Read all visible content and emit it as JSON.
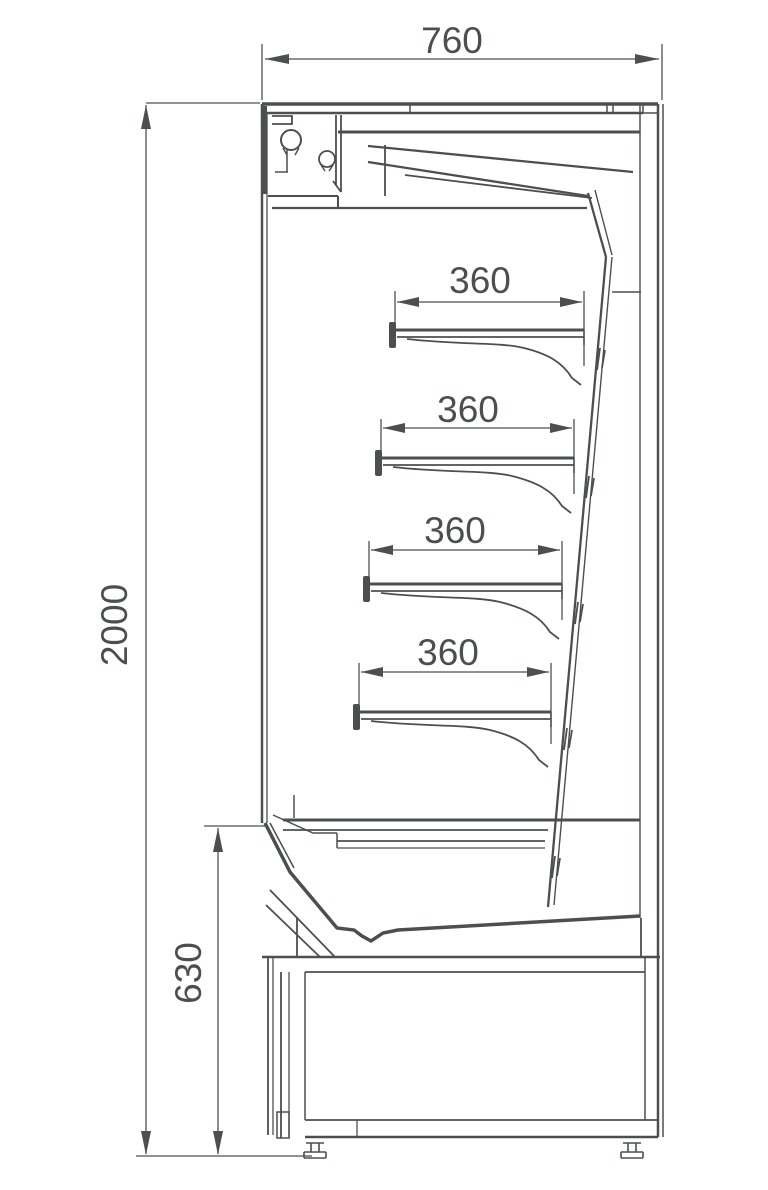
{
  "page": {
    "background": "#ffffff"
  },
  "dimensions_mm": {
    "overall_width": 760,
    "overall_height": 2000,
    "base_height": 630,
    "shelf_depths": [
      360,
      360,
      360,
      360
    ]
  },
  "drawing": {
    "viewbox": [
      0,
      0,
      768,
      1190
    ],
    "stroke": "#4b504d",
    "labels": [
      {
        "name": "dim-label-width-760",
        "text": "760",
        "x": 452,
        "y": 53,
        "rotate": 0,
        "size": 37
      },
      {
        "name": "dim-label-height-2000",
        "text": "2000",
        "x": 127,
        "y": 625,
        "rotate": -90,
        "size": 37
      },
      {
        "name": "dim-label-base-630",
        "text": "630",
        "x": 201,
        "y": 973,
        "rotate": -90,
        "size": 37
      },
      {
        "name": "dim-label-shelf1-360",
        "text": "360",
        "x": 480,
        "y": 293,
        "rotate": 0,
        "size": 37
      },
      {
        "name": "dim-label-shelf2-360",
        "text": "360",
        "x": 468,
        "y": 422,
        "rotate": 0,
        "size": 37
      },
      {
        "name": "dim-label-shelf3-360",
        "text": "360",
        "x": 455,
        "y": 543,
        "rotate": 0,
        "size": 37
      },
      {
        "name": "dim-label-shelf4-360",
        "text": "360",
        "x": 448,
        "y": 665,
        "rotate": 0,
        "size": 37
      }
    ],
    "arrows": [
      {
        "name": "arrow-760-left",
        "tip": [
          265,
          59
        ],
        "dir": "left",
        "len": 24,
        "hw": 5
      },
      {
        "name": "arrow-760-right",
        "tip": [
          659,
          59
        ],
        "dir": "right",
        "len": 24,
        "hw": 5
      },
      {
        "name": "arrow-2000-up",
        "tip": [
          146,
          105
        ],
        "dir": "up",
        "len": 24,
        "hw": 5
      },
      {
        "name": "arrow-2000-down",
        "tip": [
          146,
          1155
        ],
        "dir": "down",
        "len": 24,
        "hw": 5
      },
      {
        "name": "arrow-630-up",
        "tip": [
          218,
          828
        ],
        "dir": "up",
        "len": 24,
        "hw": 5
      },
      {
        "name": "arrow-630-down",
        "tip": [
          218,
          1155
        ],
        "dir": "down",
        "len": 24,
        "hw": 5
      },
      {
        "name": "arrow-s1-left",
        "tip": [
          397,
          302
        ],
        "dir": "left",
        "len": 22,
        "hw": 5
      },
      {
        "name": "arrow-s1-right",
        "tip": [
          582,
          302
        ],
        "dir": "right",
        "len": 22,
        "hw": 5
      },
      {
        "name": "arrow-s2-left",
        "tip": [
          383,
          428
        ],
        "dir": "left",
        "len": 22,
        "hw": 5
      },
      {
        "name": "arrow-s2-right",
        "tip": [
          572,
          428
        ],
        "dir": "right",
        "len": 22,
        "hw": 5
      },
      {
        "name": "arrow-s3-left",
        "tip": [
          371,
          550
        ],
        "dir": "left",
        "len": 22,
        "hw": 5
      },
      {
        "name": "arrow-s3-right",
        "tip": [
          560,
          550
        ],
        "dir": "right",
        "len": 22,
        "hw": 5
      },
      {
        "name": "arrow-s4-left",
        "tip": [
          361,
          672
        ],
        "dir": "left",
        "len": 22,
        "hw": 5
      },
      {
        "name": "arrow-s4-right",
        "tip": [
          549,
          672
        ],
        "dir": "right",
        "len": 22,
        "hw": 5
      }
    ],
    "circles": [
      {
        "name": "canopy-roller-large",
        "cx": 291,
        "cy": 140,
        "r": 10,
        "w": 2
      },
      {
        "name": "canopy-roller-small",
        "cx": 327,
        "cy": 159,
        "r": 8,
        "w": 1.8
      }
    ],
    "rects": [
      {
        "name": "shelf-1-front-lip",
        "x": 389,
        "y": 322,
        "w": 7,
        "h": 26
      },
      {
        "name": "shelf-2-front-lip",
        "x": 375,
        "y": 450,
        "w": 7,
        "h": 26
      },
      {
        "name": "shelf-3-front-lip",
        "x": 363,
        "y": 576,
        "w": 7,
        "h": 26
      },
      {
        "name": "shelf-4-front-lip",
        "x": 353,
        "y": 704,
        "w": 7,
        "h": 26
      }
    ],
    "paths": [
      {
        "name": "ext-760-left",
        "d": "M262,44 V100",
        "w": 1.3
      },
      {
        "name": "ext-760-right",
        "d": "M662,44 V100",
        "w": 1.3
      },
      {
        "name": "dimline-760",
        "d": "M265,59 H659",
        "w": 1.3
      },
      {
        "name": "ext-2000-top",
        "d": "M146,103 H260",
        "w": 1.3
      },
      {
        "name": "dimline-2000",
        "d": "M146,105 V1154",
        "w": 1.3
      },
      {
        "name": "ext-floor",
        "d": "M136,1156 H312",
        "w": 1.3
      },
      {
        "name": "ext-630-top",
        "d": "M204,826 H266",
        "w": 1.3
      },
      {
        "name": "dimline-630",
        "d": "M218,828 V1154",
        "w": 1.3
      },
      {
        "name": "ext-s1-left",
        "d": "M395,291 V327",
        "w": 1.3
      },
      {
        "name": "ext-s1-right",
        "d": "M584,291 V366",
        "w": 1.3
      },
      {
        "name": "dimline-s1",
        "d": "M397,302 H582",
        "w": 1.3
      },
      {
        "name": "ext-s2-left",
        "d": "M381,419 V455",
        "w": 1.3
      },
      {
        "name": "ext-s2-right",
        "d": "M574,419 V494",
        "w": 1.3
      },
      {
        "name": "dimline-s2",
        "d": "M383,428 H572",
        "w": 1.3
      },
      {
        "name": "ext-s3-left",
        "d": "M369,541 V579",
        "w": 1.3
      },
      {
        "name": "ext-s3-right",
        "d": "M562,541 V620",
        "w": 1.3
      },
      {
        "name": "dimline-s3",
        "d": "M371,550 H560",
        "w": 1.3
      },
      {
        "name": "ext-s4-left",
        "d": "M359,663 V705",
        "w": 1.3
      },
      {
        "name": "ext-s4-right",
        "d": "M551,663 V744",
        "w": 1.3
      },
      {
        "name": "dimline-s4",
        "d": "M361,672 H549",
        "w": 1.3
      },
      {
        "name": "top-cover-outer",
        "d": "M262,104 H658",
        "w": 3.5
      },
      {
        "name": "top-cover-inner",
        "d": "M262,113 H643",
        "w": 2.5
      },
      {
        "name": "top-cover-joints",
        "d": "M410,104 V113 M607,104 V113 M613,104 V113 M640,104 V113",
        "w": 1.5
      },
      {
        "name": "top-cover-end-cap",
        "d": "M643,104 V113 M658,104 V113 M643,113 H658",
        "w": 1.5
      },
      {
        "name": "top-right-drop",
        "d": "M640,113 V135",
        "w": 1.5
      },
      {
        "name": "right-wall-inner",
        "d": "M658,104 V1137",
        "w": 2.5
      },
      {
        "name": "right-wall-outer",
        "d": "M663,104 V1137",
        "w": 1.5
      },
      {
        "name": "front-edge-outer",
        "d": "M262,104 V823",
        "w": 2.5
      },
      {
        "name": "front-edge-inner",
        "d": "M267,113 V823",
        "w": 1.3
      },
      {
        "name": "front-canopy-thick",
        "d": "M264,106 V194",
        "w": 6
      },
      {
        "name": "canopy-ceiling",
        "d": "M338,132 H640",
        "w": 3
      },
      {
        "name": "canopy-front-step",
        "d": "M268,196 H338 M338,196 V208",
        "w": 2
      },
      {
        "name": "canopy-underside",
        "d": "M272,208 H587",
        "w": 2.3
      },
      {
        "name": "duct-slant-upper",
        "d": "M368,146 L633,172",
        "w": 2.3
      },
      {
        "name": "duct-slant-mid",
        "d": "M368,162 L588,196",
        "w": 2.3
      },
      {
        "name": "duct-slant-lower",
        "d": "M405,175 L592,198",
        "w": 1.8
      },
      {
        "name": "hanger-bracket-1",
        "d": "M336,115 V186 M341,115 V192 M341,192 L333,181",
        "w": 1.8
      },
      {
        "name": "hanger-bracket-2",
        "d": "M385,145 V196",
        "w": 1.8
      },
      {
        "name": "canopy-top-bracket",
        "d": "M272,116 H292 V124 H272",
        "w": 1.8
      },
      {
        "name": "roller-feet-large",
        "d": "M283,148 L287,155 M299,148 L295,155",
        "w": 1.5
      },
      {
        "name": "roller-feet-small",
        "d": "M321,165 L325,171 M333,165 L329,171",
        "w": 1.5
      },
      {
        "name": "roller-link",
        "d": "M287,150 V172 M275,172 H288",
        "w": 1.5
      },
      {
        "name": "back-top-outer",
        "d": "M588,193 L606,257",
        "w": 2.3
      },
      {
        "name": "back-top-inner",
        "d": "M595,190 L612,255",
        "w": 1.4
      },
      {
        "name": "back-panel-outer",
        "d": "M606,257 L548,907",
        "w": 2.3
      },
      {
        "name": "back-panel-inner",
        "d": "M612,257 L554,905",
        "w": 1.4
      },
      {
        "name": "rear-duct-wall",
        "d": "M640,135 V918",
        "w": 1.4
      },
      {
        "name": "rear-duct-vane",
        "d": "M612,292 H641",
        "w": 1.4
      },
      {
        "name": "rear-duct-foot",
        "d": "M641,918 V957",
        "w": 1.8
      },
      {
        "name": "back-panel-clips",
        "d": "M600,348 L597,370 M605,350 L602,368 M589,476 L586,498 M594,478 L591,496 M578,602 L575,624 M583,604 L580,622 M567,728 L564,750 M572,730 L569,748 M555,856 L552,878 M560,858 L557,876",
        "w": 1.8
      },
      {
        "name": "shelf-1-top",
        "d": "M395,330 H584",
        "w": 3
      },
      {
        "name": "shelf-1-bottom",
        "d": "M397,337 H584",
        "w": 1.8
      },
      {
        "name": "shelf-1-end",
        "d": "M584,330 V345",
        "w": 1.5
      },
      {
        "name": "shelf-1-bracket",
        "d": "M407,339 C460,345 500,342 524,348 C548,354 562,362 572,378 L581,385",
        "w": 1.8
      },
      {
        "name": "shelf-2-top",
        "d": "M381,458 H574",
        "w": 3
      },
      {
        "name": "shelf-2-bottom",
        "d": "M383,465 H574",
        "w": 1.8
      },
      {
        "name": "shelf-2-end",
        "d": "M574,458 V473",
        "w": 1.5
      },
      {
        "name": "shelf-2-bracket",
        "d": "M393,467 C446,473 488,470 512,476 C536,482 552,490 562,506 L571,513",
        "w": 1.8
      },
      {
        "name": "shelf-3-top",
        "d": "M369,584 H562",
        "w": 3
      },
      {
        "name": "shelf-3-bottom",
        "d": "M371,591 H562",
        "w": 1.8
      },
      {
        "name": "shelf-3-end",
        "d": "M562,584 V599",
        "w": 1.5
      },
      {
        "name": "shelf-3-bracket",
        "d": "M381,593 C434,599 476,596 500,602 C524,608 540,616 550,632 L559,639",
        "w": 1.8
      },
      {
        "name": "shelf-4-top",
        "d": "M359,712 H551",
        "w": 3
      },
      {
        "name": "shelf-4-bottom",
        "d": "M361,719 H551",
        "w": 1.8
      },
      {
        "name": "shelf-4-end",
        "d": "M551,712 V727",
        "w": 1.5
      },
      {
        "name": "shelf-4-bracket",
        "d": "M371,721 C424,727 466,724 490,730 C514,736 529,744 539,760 L548,767",
        "w": 1.8
      },
      {
        "name": "deck-top",
        "d": "M283,820 H640",
        "w": 3
      },
      {
        "name": "deck-top-inner",
        "d": "M283,830 H548",
        "w": 1.8
      },
      {
        "name": "deck-step",
        "d": "M337,841 H545",
        "w": 1.8
      },
      {
        "name": "deck-step-inner",
        "d": "M337,848 H545",
        "w": 1.3
      },
      {
        "name": "front-grille",
        "d": "M273,815 L313,833 H337 M337,833 V848",
        "w": 1.5
      },
      {
        "name": "grille-support",
        "d": "M294,795 V818",
        "w": 1.5
      },
      {
        "name": "pan-profile",
        "d": "M265,823 L290,872 L337,928 L354,930 L362,936 L371,941 L383,933 L398,930 L640,916",
        "w": 3.5
      },
      {
        "name": "pan-inner",
        "d": "M270,823 L294,868",
        "w": 1.5
      },
      {
        "name": "base-front-brace",
        "d": "M270,890 L335,957 M266,905 L320,957 M297,917 V957",
        "w": 1.8
      },
      {
        "name": "base-top",
        "d": "M262,957 H660",
        "w": 2.5
      },
      {
        "name": "base-top-inner",
        "d": "M305,972 H645",
        "w": 1.8
      },
      {
        "name": "base-right-step",
        "d": "M645,957 V972",
        "w": 1.5
      },
      {
        "name": "base-right-wall",
        "d": "M645,972 V1120",
        "w": 1.5
      },
      {
        "name": "base-front-1",
        "d": "M268,957 V1135",
        "w": 1.8
      },
      {
        "name": "base-front-2",
        "d": "M273,957 V1135",
        "w": 1.3
      },
      {
        "name": "base-front-3",
        "d": "M281,972 V1138",
        "w": 1.8
      },
      {
        "name": "base-front-4",
        "d": "M289,972 V1138",
        "w": 1.3
      },
      {
        "name": "base-kick-detail",
        "d": "M277,1112 H289 V1138 H277 Z",
        "w": 1.5
      },
      {
        "name": "base-front-5",
        "d": "M305,972 V1120",
        "w": 1.5
      },
      {
        "name": "base-bottom-top",
        "d": "M305,1120 H658",
        "w": 1.8
      },
      {
        "name": "base-bottom",
        "d": "M305,1137 H658",
        "w": 2.5
      },
      {
        "name": "base-bottom-joint",
        "d": "M357,1120 V1137",
        "w": 1.3
      },
      {
        "name": "base-bottom-cap",
        "d": "M658,1120 V1137",
        "w": 1.5
      },
      {
        "name": "foot-left",
        "d": "M306,1137 H324 M306,1143 H324 M311,1143 V1152 M319,1143 V1152 M304,1152 H326 M304,1158 H326 M304,1152 V1158 M326,1152 V1158",
        "w": 1.6
      },
      {
        "name": "foot-right",
        "d": "M623,1137 H641 M623,1143 H641 M628,1143 V1152 M636,1143 V1152 M621,1152 H643 M621,1158 H643 M621,1152 V1158 M643,1152 V1158",
        "w": 1.6
      }
    ]
  }
}
